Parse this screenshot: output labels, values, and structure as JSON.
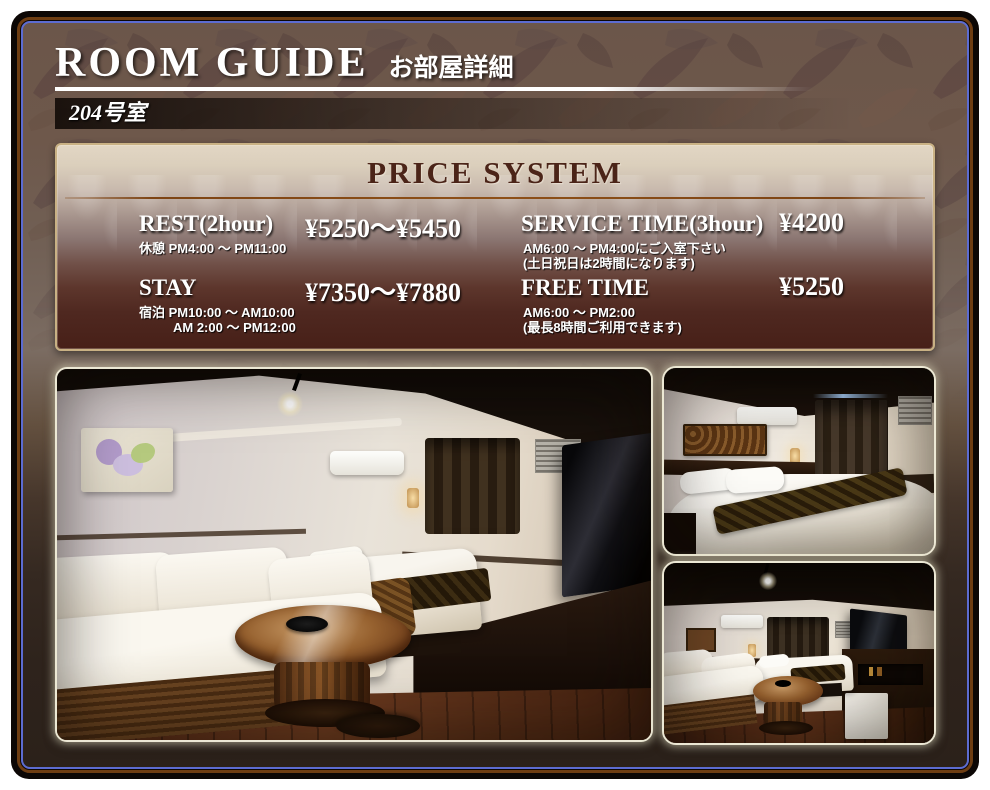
{
  "page": {
    "header": {
      "title": "ROOM GUIDE",
      "subtitle": "お部屋詳細"
    },
    "room_label": "204号室",
    "price_panel": {
      "title": "PRICE SYSTEM",
      "items": [
        {
          "name": "REST(2hour)",
          "price": "¥5250～¥5450",
          "notes": [
            "休憩 PM4:00 ～ PM11:00"
          ]
        },
        {
          "name": "STAY",
          "price": "¥7350～¥7880",
          "notes": [
            "宿泊 PM10:00 ～ AM10:00",
            "AM 2:00 ～ PM12:00"
          ]
        },
        {
          "name": "SERVICE TIME(3hour)",
          "price": "¥4200",
          "notes": [
            "AM6:00 ～ PM4:00にご入室下さい",
            "(土日祝日は2時間になります)"
          ]
        },
        {
          "name": "FREE TIME",
          "price": "¥5250",
          "notes": [
            "AM6:00 ～ PM2:00",
            "(最長8時間ご利用できます)"
          ]
        }
      ]
    },
    "colors": {
      "panel_border_gold": "#c9b184",
      "panel_title_brown": "#4b2418",
      "frame_blue_line": "#5c6cd2",
      "frame_brown_line": "#6e3d12",
      "header_text": "#ffffff",
      "background_dark": "#2b211a"
    }
  }
}
